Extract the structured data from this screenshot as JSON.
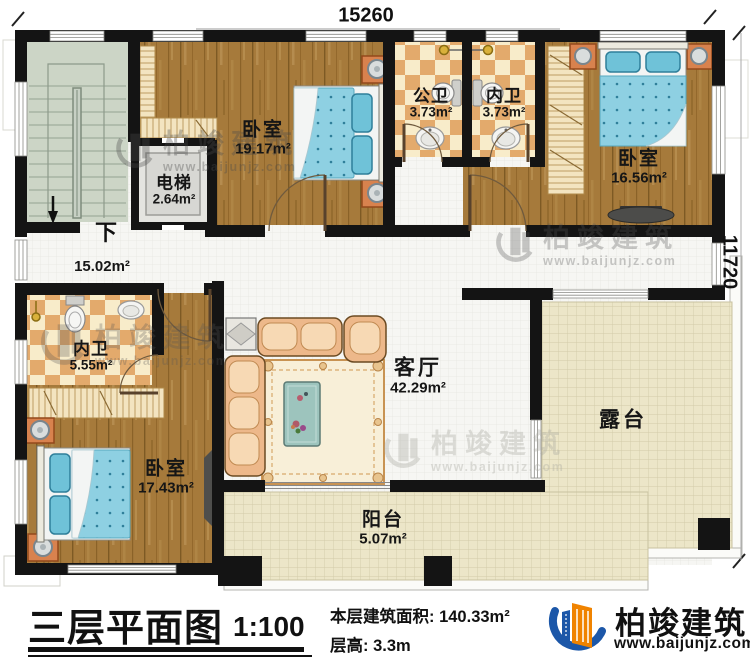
{
  "dimensions": {
    "width_mm": "15260",
    "height_mm": "11720"
  },
  "rooms": [
    {
      "id": "bedroom-1",
      "name": "卧室",
      "area": "19.17m²"
    },
    {
      "id": "elevator",
      "name": "电梯",
      "area": "2.64m²"
    },
    {
      "id": "public-bathroom",
      "name": "公卫",
      "area": "3.73m²"
    },
    {
      "id": "ensuite-bathroom-top",
      "name": "内卫",
      "area": "3.73m²"
    },
    {
      "id": "bedroom-2",
      "name": "卧室",
      "area": "16.56m²"
    },
    {
      "id": "hallway",
      "name": "",
      "area": "15.02m²"
    },
    {
      "id": "ensuite-bathroom-left",
      "name": "内卫",
      "area": "5.55m²"
    },
    {
      "id": "bedroom-3",
      "name": "卧室",
      "area": "17.43m²"
    },
    {
      "id": "living-room",
      "name": "客厅",
      "area": "42.29m²"
    },
    {
      "id": "terrace",
      "name": "露台",
      "area": ""
    },
    {
      "id": "balcony",
      "name": "阳台",
      "area": "5.07m²"
    }
  ],
  "stairs": {
    "direction_label": "下"
  },
  "title_block": {
    "title": "三层平面图",
    "scale": "1:100",
    "floor_area": "本层建筑面积: 140.33m²",
    "floor_height": "层高: 3.3m"
  },
  "brand": {
    "name": "柏竣建筑",
    "website": "www.baijunjz.com"
  },
  "watermark": {
    "name": "柏竣建筑",
    "website": "www.baijunjz.com"
  }
}
